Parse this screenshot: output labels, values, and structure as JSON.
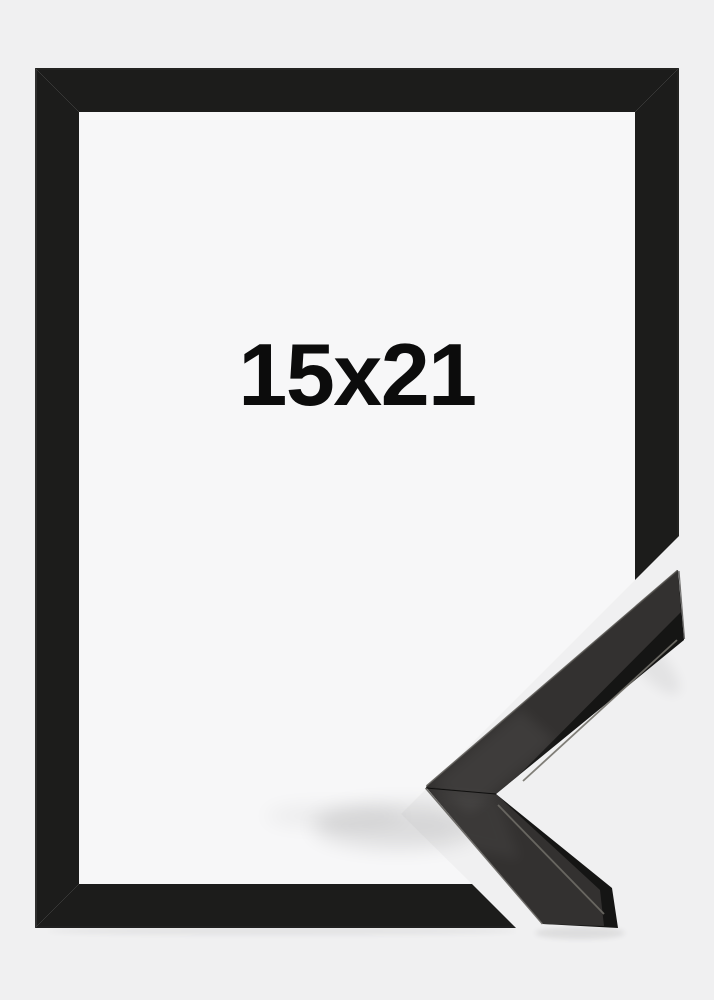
{
  "image": {
    "size_label": "15x21",
    "colors": {
      "background": "#f0f0f1",
      "inner_area": "#f7f7f8",
      "frame": "#1c1c1b",
      "molding_side": "#151514",
      "molding_top": "#333130",
      "text": "#0c0c0c"
    }
  }
}
